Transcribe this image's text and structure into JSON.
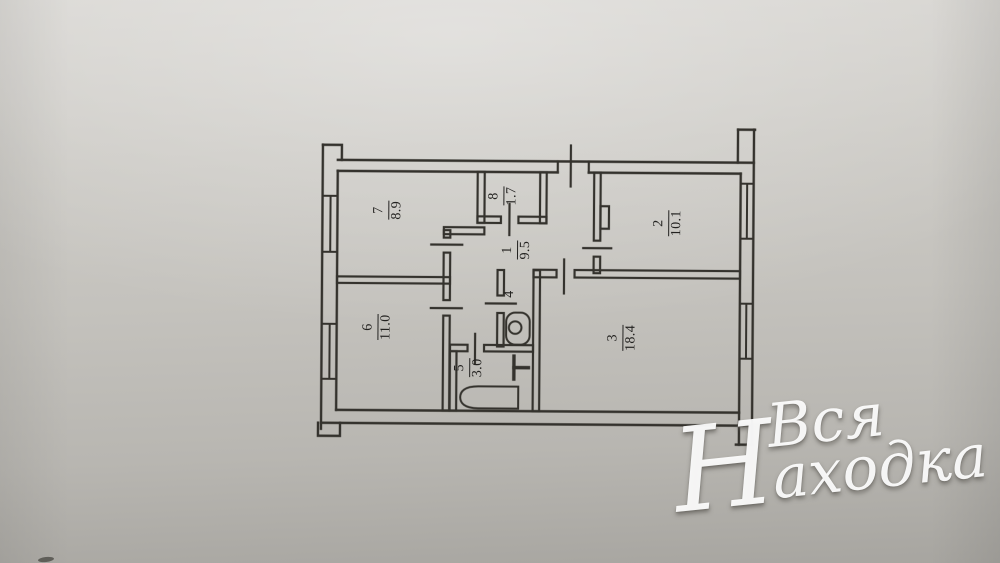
{
  "plan": {
    "title_hint": "apartment floor plan scan",
    "rooms": [
      {
        "number": "7",
        "area": "8.9"
      },
      {
        "number": "8",
        "area": "1.7"
      },
      {
        "number": "2",
        "area": "10.1"
      },
      {
        "number": "1",
        "area": "9.5"
      },
      {
        "number": "4",
        "area": ""
      },
      {
        "number": "6",
        "area": "11.0"
      },
      {
        "number": "3",
        "area": "18.4"
      },
      {
        "number": "5",
        "area": "3.0"
      }
    ],
    "fixtures": [
      "bathtub",
      "toilet",
      "washbasin"
    ]
  },
  "watermark": {
    "line1": "Вся",
    "initial": "Н",
    "rest": "аходка"
  },
  "colors": {
    "paper": "#c4c2bd",
    "line": "#34322d",
    "watermark": "#ffffff"
  }
}
